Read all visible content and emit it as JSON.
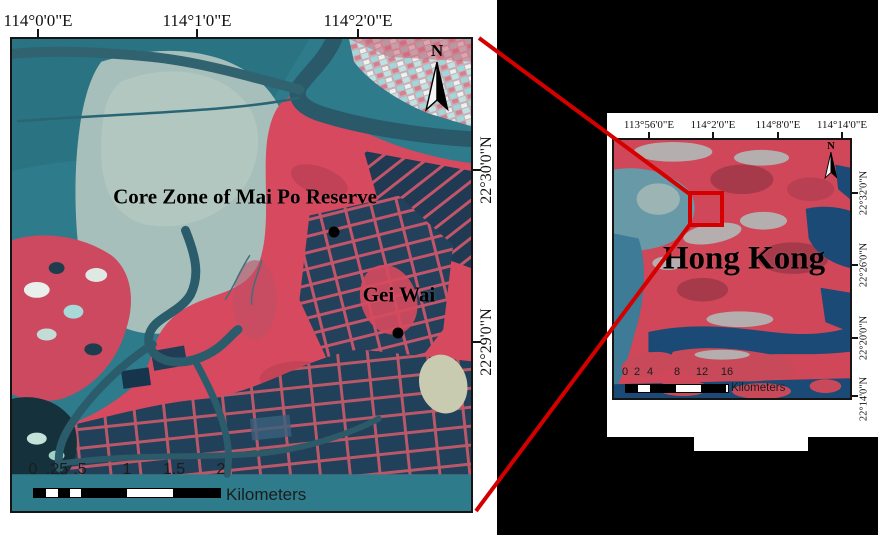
{
  "main_map": {
    "top_axis_labels": [
      "114°0'0\"E",
      "114°1'0\"E",
      "114°2'0\"E"
    ],
    "right_axis_labels": [
      "22°30'0\"N",
      "22°29'0\"N"
    ],
    "annotations": {
      "core_zone": "Core Zone of Mai Po Reserve",
      "gei_wai": "Gei Wai"
    },
    "north_label": "N",
    "scale_bar": {
      "tick_labels": [
        "0",
        ".25",
        ".5",
        "1",
        "1.5",
        "2"
      ],
      "unit_label": "Kilometers"
    }
  },
  "inset_map": {
    "top_axis_labels": [
      "113°56'0\"E",
      "114°2'0\"E",
      "114°8'0\"E",
      "114°14'0\"E"
    ],
    "right_axis_labels": [
      "22°32'0\"N",
      "22°26'0\"N",
      "22°20'0\"N",
      "22°14'0\"N"
    ],
    "region_label": "Hong Kong",
    "north_label": "N",
    "scale_bar": {
      "tick_labels": [
        "0",
        "2",
        "4",
        "8",
        "12",
        "16"
      ],
      "unit_label": "Kilometers"
    }
  },
  "colors": {
    "background": "#000000",
    "panel_white": "#ffffff",
    "connector_red": "#d40000",
    "water_teal": "#2e7b8b",
    "mudflat_gray": "#a7bfba",
    "vegetation_red": "#d6495e",
    "pond_dark_blue": "#21405a",
    "harbour_blue": "#1c4a76"
  }
}
